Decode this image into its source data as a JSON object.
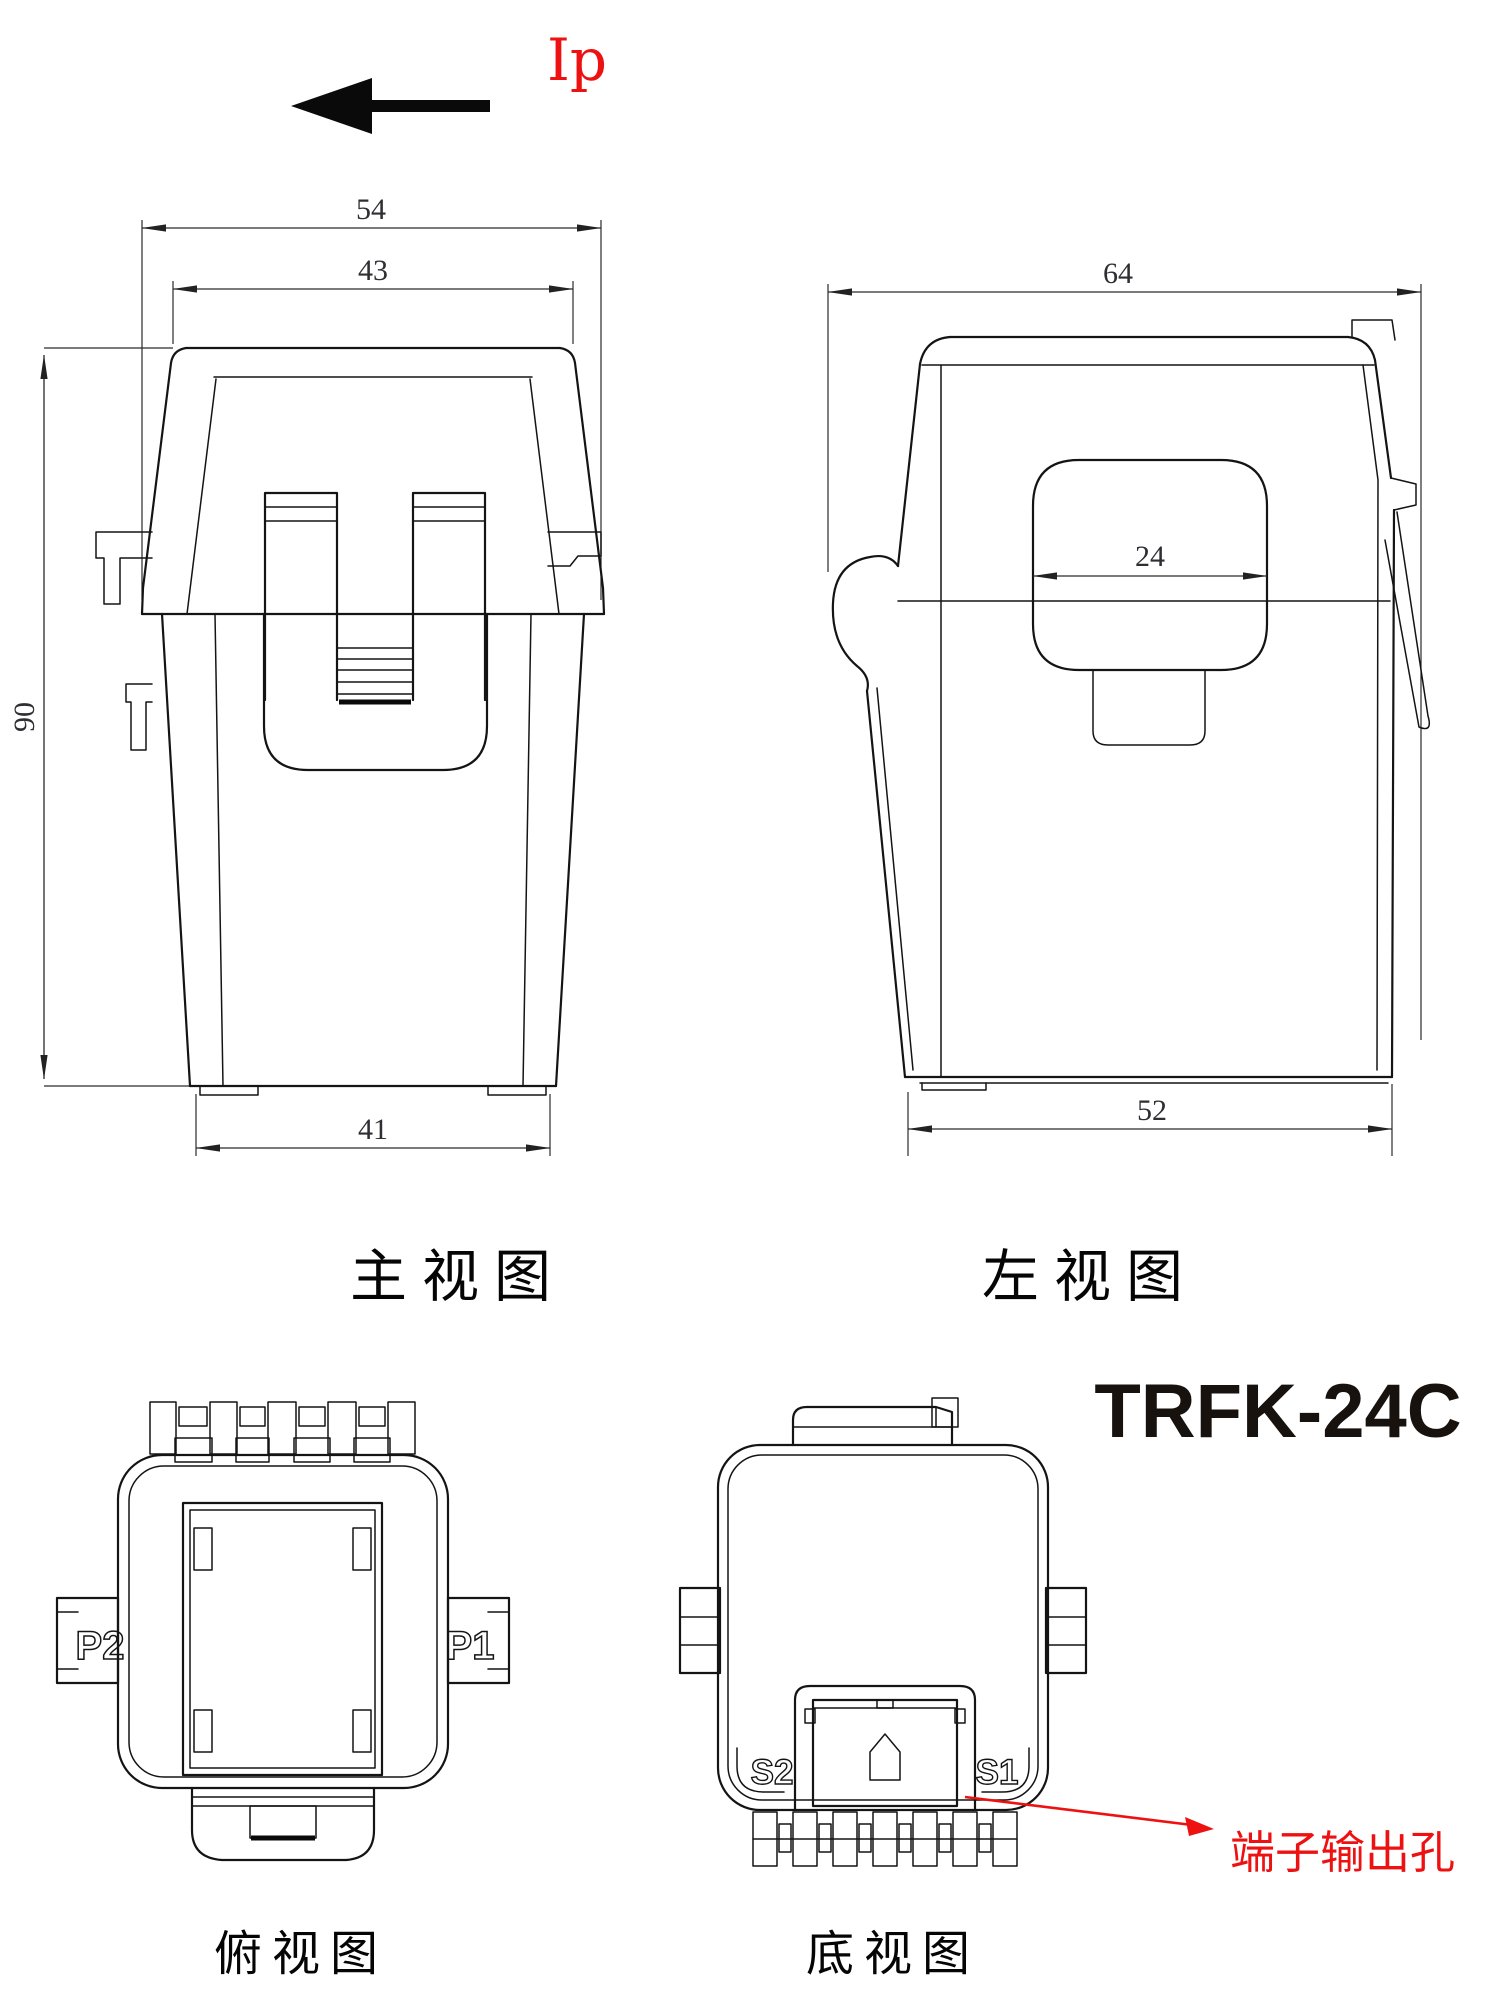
{
  "model": "TRFK-24C",
  "ip_label": "Ip",
  "colors": {
    "line": "#141414",
    "dim_text": "#2e2e33",
    "red": "#ee1111",
    "background": "#ffffff"
  },
  "views": {
    "front": {
      "label": "主视图",
      "dim_outer_width": "54",
      "dim_top_width": "43",
      "dim_height": "90",
      "dim_bottom_width": "41"
    },
    "left": {
      "label": "左视图",
      "dim_depth": "64",
      "dim_window_width": "24",
      "dim_bottom_depth": "52"
    },
    "top": {
      "label": "俯视图",
      "terminal_left": "P2",
      "terminal_right": "P1"
    },
    "bottom": {
      "label": "底视图",
      "terminal_left": "S2",
      "terminal_right": "S1",
      "annotation": "端子输出孔"
    }
  }
}
